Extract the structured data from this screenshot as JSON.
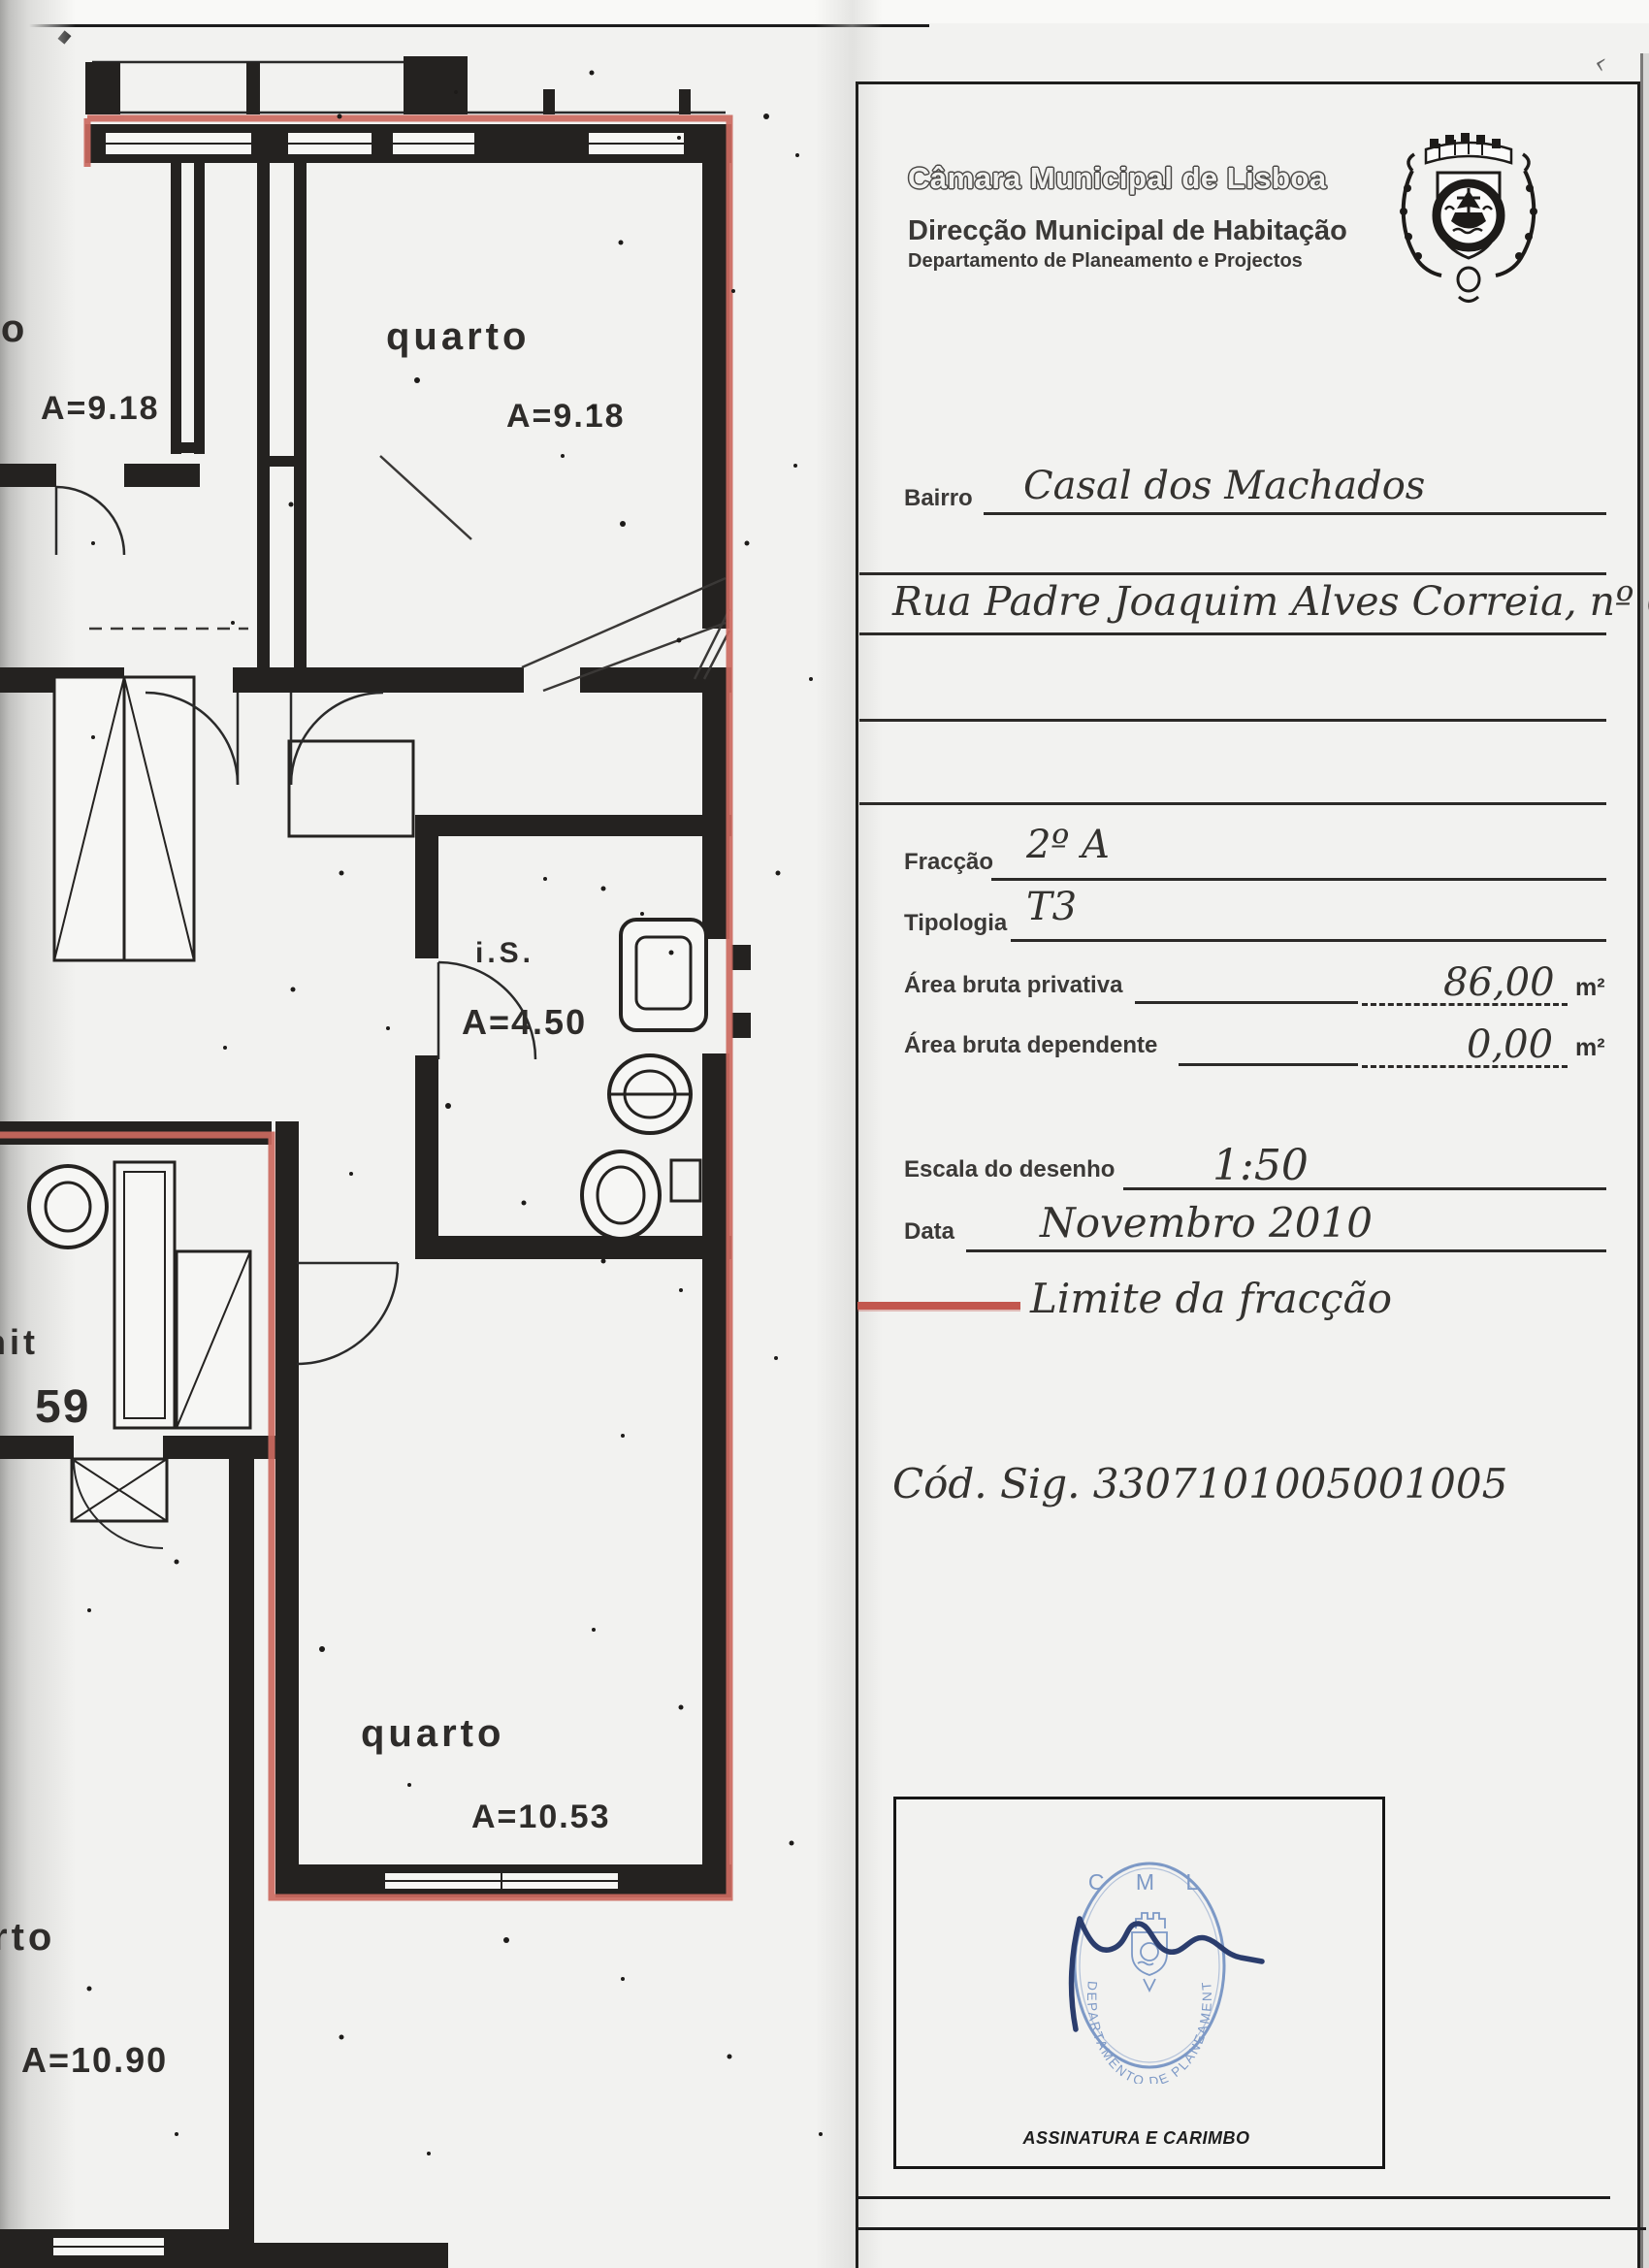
{
  "header": {
    "org": "Câmara Municipal de Lisboa",
    "direction": "Direcção Municipal de Habitação",
    "department": "Departamento de Planeamento e Projectos"
  },
  "form": {
    "bairro_label": "Bairro",
    "bairro_value": "Casal dos Machados",
    "address_value": "Rua Padre Joaquim Alves Correia, nº 6",
    "fraccao_label": "Fracção",
    "fraccao_value": "2º A",
    "tipologia_label": "Tipologia",
    "tipologia_value": "T3",
    "area_privativa_label": "Área bruta privativa",
    "area_privativa_value": "86,00",
    "area_dependente_label": "Área bruta dependente",
    "area_dependente_value": "0,00",
    "area_unit": "m²",
    "escala_label": "Escala do desenho",
    "escala_value": "1:50",
    "data_label": "Data",
    "data_value": "Novembro 2010"
  },
  "legend": {
    "label": "Limite da fracção",
    "line_color": "#c2574e"
  },
  "cod_sig": "Cód. Sig. 3307101005001005",
  "signature": {
    "stamp_line1": "C M L",
    "stamp_ring_text": "DEPARTAMENTO DE PLANEAMENTO E PROJECTOS",
    "caption": "ASSINATURA E CARIMBO",
    "stamp_color": "#7d99c6",
    "ink_color": "#2b3d6d"
  },
  "plan": {
    "boundary_color": "#cc6a60",
    "rooms": [
      {
        "label": "rto",
        "area": "A=9.18"
      },
      {
        "label": "quarto",
        "area": "A=9.18"
      },
      {
        "label": "i.S.",
        "area": "A=4.50"
      },
      {
        "label": "zanit",
        "area": "59"
      },
      {
        "label": "quarto",
        "area": "A=10.53"
      },
      {
        "label": "rto",
        "area": "A=10.90"
      }
    ]
  }
}
